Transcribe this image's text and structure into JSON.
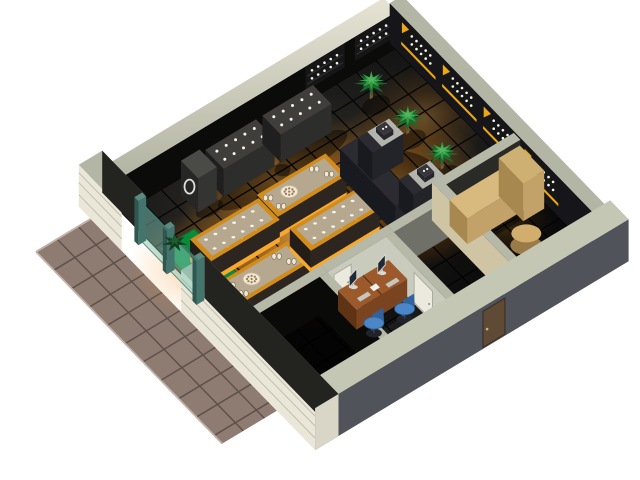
{
  "scene": {
    "name": "isometric-shop-floorplan-render",
    "description": "3D isometric cutaway rendering of a retail shop interior with lit display tables, cashier counter, office and entrance patio",
    "background": "#ffffff"
  },
  "palette": {
    "bg": "#ffffff",
    "floor_base_light": "#3a352b",
    "floor_base_dark": "#121212",
    "floor_line": "#060606",
    "patio_tile": "#8e7b72",
    "patio_line": "#5e5048",
    "patio_edge": "#c4b3a7",
    "wall_top_sage": "#b3b6a4",
    "wall_top_cream_a": "#e6e3d4",
    "wall_top_cream_b": "#aeb19f",
    "wall_inner_dark": "#0b0b0a",
    "wall_inner_dark2": "#15151a",
    "wall_plank": "#eae7d9",
    "wall_plank_line": "rgba(90,85,70,0.28)",
    "wall_front_dark": "#50535a",
    "wall_front_top": "#c5c7b5",
    "partition_top": "#b6b9a7",
    "partition_lit": "#c9cbbd",
    "partition_warm": "#cfc5a5",
    "partition_dim": "#6f7168",
    "partition_dark": "#0a0a09",
    "carpet_green": "#0c8a3c",
    "carpet_edge": "#086a2d",
    "entrance_teal": "#44756c",
    "entrance_teal_dark": "#2f5651",
    "entrance_glass": "rgba(130,200,185,0.48)",
    "glow_core": "#ffb347",
    "glow_mid": "#f08a14",
    "table_skirt": "#f7a82e",
    "table_rim": "#d28c1c",
    "table_inner": "#b6a88f",
    "table_side_l": "#221d18",
    "table_side_f": "#2d2620",
    "plate_cream": "#efe8d8",
    "plate_edge": "#cdbb97",
    "plate_dot": "#9a7948",
    "item_white": "#f5f5ee",
    "counter_dark_top": "#3f3e3a",
    "counter_dark_l": "#1f1f1f",
    "counter_dark_f": "#2d2d2b",
    "cashier_top": "#2b2b31",
    "cashier_l": "#191920",
    "cashier_f": "#23232a",
    "cashier_cap": "#b4b4ae",
    "register_dark": "#26262a",
    "desk_top": "#9c5a2c",
    "desk_l": "#5f3415",
    "desk_f": "#7a4421",
    "chair_blue": "#4a86c8",
    "chair_blue_dark": "#33639c",
    "chair_base": "#20242a",
    "monitor_frame": "#d8d8d4",
    "monitor_screen": "#202a36",
    "keyboard": "#c4c6c0",
    "door_white": "#eceade",
    "door_frame": "#a9aca0",
    "door_brown": "#5f4a35",
    "door_brown_edge": "#3e3028",
    "knob_brass": "#c9b37a",
    "tan_top": "#d8ba7e",
    "tan_l": "#a7884f",
    "tan_f": "#c2a268",
    "stool_tan": "#d2ae6e",
    "stool_side": "#9a7a48",
    "palm_dark": "#1a6b2d",
    "palm_mid": "#2f9e44",
    "palm_light": "#53b45f",
    "plant_dark": "#123c1e",
    "shelf_black": "#161616",
    "shelf_yellow": "#eda714",
    "shelf_line": "#333333",
    "shadow": "rgba(0,0,0,0.42)"
  },
  "projection": {
    "origin": [
      122,
      213
    ],
    "u_axis": [
      0.78,
      -0.47
    ],
    "v_axis": [
      0.66,
      0.68
    ],
    "floor_size": [
      350,
      300
    ],
    "wall_height": 42
  },
  "objects": {
    "patio": {
      "u": [
        -100,
        -30
      ],
      "v": [
        -12,
        270
      ],
      "step": 27
    },
    "floor": {
      "u": [
        0,
        350
      ],
      "v": [
        0,
        300
      ],
      "step": 25
    },
    "carpet": {
      "u": [
        4,
        46
      ],
      "v": [
        55,
        145
      ]
    },
    "glows": [
      {
        "name": "main-floor-glow",
        "cx": 130,
        "cy": 120,
        "rx": 150,
        "ry": 105,
        "o": 0.85,
        "grad": "warm"
      },
      {
        "name": "cashier-glow",
        "cx": 240,
        "cy": 130,
        "rx": 100,
        "ry": 95,
        "o": 0.8,
        "grad": "warm"
      },
      {
        "name": "back-counter-glow",
        "cx": 150,
        "cy": 55,
        "rx": 110,
        "ry": 60,
        "o": 0.55,
        "grad": "warm"
      },
      {
        "name": "entrance-glow",
        "cx": 20,
        "cy": 90,
        "rx": 70,
        "ry": 60,
        "o": 0.5,
        "grad": "warm"
      },
      {
        "name": "corridor-glow",
        "cx": 235,
        "cy": 175,
        "rx": 60,
        "ry": 55,
        "o": 0.7,
        "grad": "warm"
      },
      {
        "name": "right-wall-glow",
        "cx": 320,
        "cy": 80,
        "rx": 80,
        "ry": 60,
        "o": 0.35,
        "grad": "warm"
      },
      {
        "name": "back-room-glow",
        "cx": 300,
        "cy": 225,
        "rx": 50,
        "ry": 45,
        "o": 0.4,
        "grad": "warm"
      },
      {
        "name": "office-glow",
        "cx": 127,
        "cy": 250,
        "rx": 55,
        "ry": 40,
        "o": 0.18,
        "grad": "cool"
      }
    ],
    "table_glow": {
      "rx": 62,
      "ry": 34,
      "o": 0.9
    },
    "overlays": [
      {
        "name": "dark-room-floor",
        "u": [
          0,
          80
        ],
        "v": [
          205,
          300
        ],
        "fill": "rgba(0,0,0,0.85)"
      },
      {
        "name": "office-floor",
        "u": [
          90,
          165
        ],
        "v": [
          205,
          300
        ],
        "fill": "rgba(0,0,0,0.28)"
      },
      {
        "name": "corridor-floor",
        "u": [
          175,
          245
        ],
        "v": [
          205,
          300
        ],
        "fill": "rgba(0,0,0,0.5)"
      },
      {
        "name": "back-room-floor",
        "u": [
          255,
          350
        ],
        "v": [
          190,
          300
        ],
        "fill": "rgba(0,0,0,0.45)"
      }
    ],
    "shadows": [
      {
        "cx": 127,
        "cy": 50,
        "rx": 45,
        "ry": 14
      },
      {
        "cx": 200,
        "cy": 50,
        "rx": 45,
        "ry": 14
      },
      {
        "cx": 74,
        "cy": 45,
        "rx": 16,
        "ry": 8
      },
      {
        "cx": 236,
        "cy": 132,
        "rx": 55,
        "ry": 48
      },
      {
        "cx": 290,
        "cy": 42,
        "rx": 16,
        "ry": 10
      },
      {
        "cx": 292,
        "cy": 94,
        "rx": 16,
        "ry": 10
      },
      {
        "cx": 292,
        "cy": 146,
        "rx": 16,
        "ry": 10
      },
      {
        "cx": 128,
        "cy": 236,
        "rx": 45,
        "ry": 18
      },
      {
        "cx": 300,
        "cy": 214,
        "rx": 55,
        "ry": 16
      },
      {
        "cx": 300,
        "cy": 262,
        "rx": 14,
        "ry": 9
      }
    ],
    "display_tables": {
      "half_len": 44,
      "half_wid": 16,
      "height": 22,
      "items": [
        {
          "type": "plate",
          "u": 150,
          "v": 95
        },
        {
          "type": "rows",
          "u": 61,
          "v": 99
        },
        {
          "type": "plate",
          "u": 51,
          "v": 155
        },
        {
          "type": "rows",
          "u": 150,
          "v": 145
        }
      ]
    },
    "wall_counters": {
      "v": [
        14,
        42
      ],
      "h": 28,
      "units": [
        [
          95,
          160
        ],
        [
          168,
          233
        ]
      ]
    },
    "pedestal": {
      "u": [
        62,
        86
      ],
      "v": [
        16,
        42
      ],
      "h": 34
    },
    "cashier_counter": {
      "spine": {
        "u": [
          205,
          228
        ],
        "v": [
          88,
          172
        ]
      },
      "arms": [
        {
          "u": [
            228,
            268
          ],
          "v": [
            88,
            110
          ]
        },
        {
          "u": [
            228,
            268
          ],
          "v": [
            150,
            172
          ]
        }
      ],
      "h": 28,
      "caps": [
        [
          240,
          268,
          88,
          110
        ],
        [
          240,
          268,
          150,
          172
        ]
      ],
      "registers": [
        [
          247,
          93
        ],
        [
          247,
          155
        ]
      ]
    },
    "palms": [
      [
        290,
        35
      ],
      [
        292,
        88
      ],
      [
        292,
        140
      ]
    ],
    "entry_plant": [
      10,
      68
    ],
    "shelves_right_wall": {
      "v0": [
        10,
        72,
        134,
        196
      ],
      "len": 52,
      "z": [
        12,
        36
      ]
    },
    "shelves_back_wall": {
      "u0": [
        235,
        298
      ],
      "len": 50,
      "z": [
        12,
        36
      ]
    },
    "partitions": {
      "rooms_back_wall_dark": {
        "u": [
          0,
          90
        ],
        "v": [
          195,
          205
        ]
      },
      "rooms_back_wall_lit": {
        "u": [
          90,
          175
        ],
        "v": [
          195,
          205
        ]
      },
      "corridor_back_wall": {
        "u": [
          175,
          245
        ],
        "v": [
          195,
          205
        ]
      },
      "back_room_rear_wall": {
        "u": [
          245,
          350
        ],
        "v": [
          180,
          190
        ]
      },
      "office_left_wall": {
        "u": [
          80,
          90
        ],
        "v": [
          205,
          300
        ]
      },
      "office_right_wall": {
        "u": [
          165,
          175
        ],
        "v": [
          205,
          300
        ]
      },
      "back_room_left_wall": {
        "u": [
          245,
          255
        ],
        "v": [
          180,
          300
        ]
      },
      "h": 38
    },
    "office": {
      "desks": {
        "u": [
          95,
          160
        ],
        "v": [
          215,
          243
        ],
        "h": 24,
        "split": 127
      },
      "monitors": [
        [
          110,
          221
        ],
        [
          144,
          224
        ]
      ],
      "keyboards": [
        [
          111,
          233
        ],
        [
          145,
          236
        ]
      ],
      "paper": [
        127,
        230
      ],
      "chairs": [
        [
          108,
          254
        ],
        [
          144,
          258
        ]
      ]
    },
    "back_room": {
      "counter": {
        "u": [
          255,
          345
        ],
        "v": [
          195,
          222
        ],
        "h": 26
      },
      "raised_block": {
        "u": [
          318,
          345
        ],
        "v": [
          195,
          232
        ],
        "h": 38
      },
      "stool": [
        300,
        258
      ]
    },
    "doors": {
      "office_white": {
        "u": [
          98,
          120
        ]
      },
      "hall_white": {
        "v": [
          248,
          276
        ]
      },
      "exterior_brown": {
        "u": [
          185,
          213
        ]
      }
    },
    "entrance": {
      "gap_v": [
        35,
        125
      ],
      "posts": [
        33,
        76,
        121
      ],
      "post_w": 6,
      "panels": [
        [
          39,
          76
        ],
        [
          82,
          121
        ]
      ]
    }
  }
}
